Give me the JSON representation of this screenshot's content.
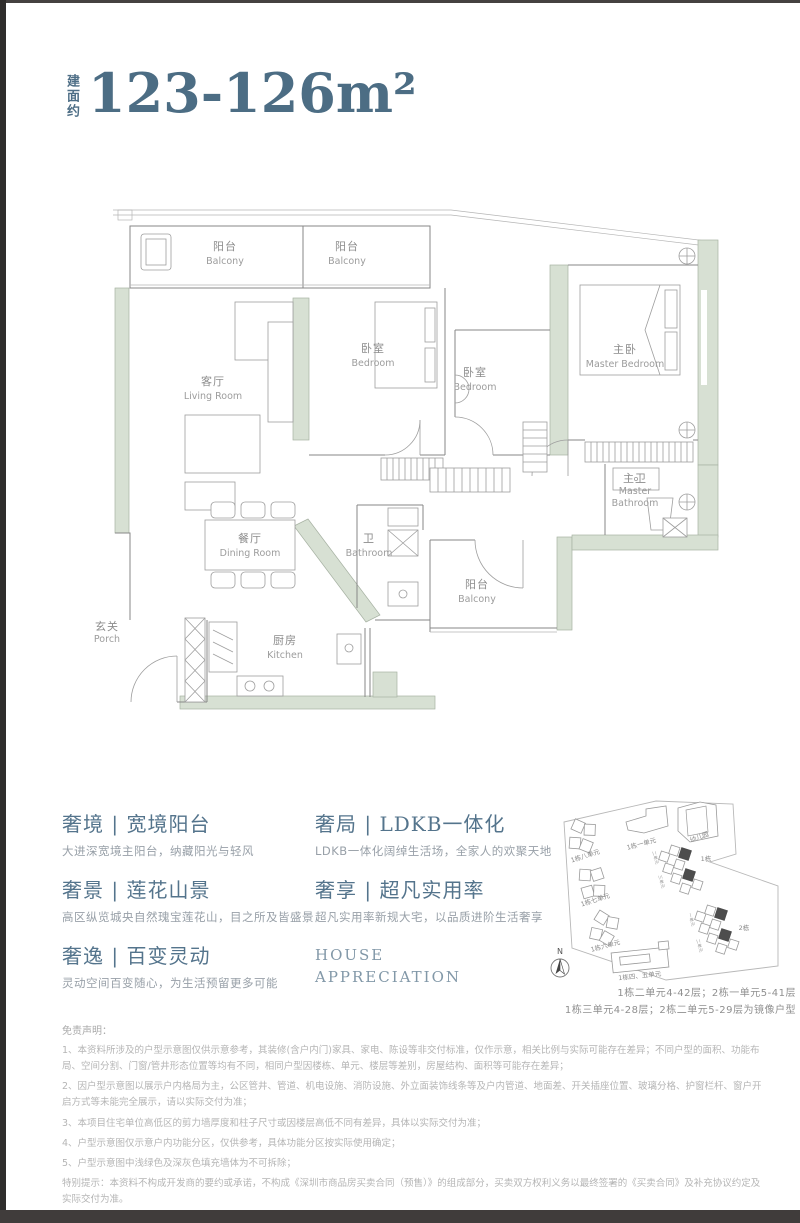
{
  "header": {
    "prefix": "建面约",
    "area": "123-126m²"
  },
  "floorplan": {
    "rooms": [
      {
        "cn": "阳台",
        "en": "Balcony"
      },
      {
        "cn": "阳台",
        "en": "Balcony"
      },
      {
        "cn": "客厅",
        "en": "Living Room"
      },
      {
        "cn": "卧室",
        "en": "Bedroom"
      },
      {
        "cn": "卧室",
        "en": "Bedroom"
      },
      {
        "cn": "主卧",
        "en": "Master Bedroom"
      },
      {
        "cn": "主卫",
        "en1": "Master",
        "en2": "Bathroom"
      },
      {
        "cn": "餐厅",
        "en": "Dining Room"
      },
      {
        "cn": "卫",
        "en": "Bathroom"
      },
      {
        "cn": "阳台",
        "en": "Balcony"
      },
      {
        "cn": "玄关",
        "en": "Porch"
      },
      {
        "cn": "厨房",
        "en": "Kitchen"
      }
    ]
  },
  "features": {
    "left": [
      {
        "title": "奢境 | 宽境阳台",
        "desc": "大进深宽境主阳台，纳藏阳光与轻风"
      },
      {
        "title": "奢景 | 莲花山景",
        "desc": "高区纵览城央自然瑰宝莲花山，目之所及皆盛景"
      },
      {
        "title": "奢逸 | 百变灵动",
        "desc": "灵动空间百变随心，为生活预留更多可能"
      }
    ],
    "right": [
      {
        "title": "奢局 | LDKB一体化",
        "desc": "LDKB一体化阔绰生活场，全家人的欢聚天地"
      },
      {
        "title": "奢享 | 超凡实用率",
        "desc": "超凡实用率新规大宅，以品质进阶生活奢享"
      }
    ],
    "brand_line1": "HOUSE",
    "brand_line2": "APPRECIATION"
  },
  "sitemap": {
    "buildings": {
      "b1u8": "1栋八单元",
      "b1u1": "1栋一单元",
      "kindergarten": "幼儿园",
      "b1": "1栋",
      "b1u7": "1栋七单元",
      "b1u6": "1栋六单元",
      "b2": "2栋",
      "b1u45": "1栋四、五单元",
      "u2": "二单元",
      "u3": "三单元",
      "u1": "一单元",
      "u2b": "二单元"
    },
    "north": "N",
    "caption1": "1栋二单元4-42层；2栋一单元5-41层",
    "caption2": "1栋三单元4-28层；2栋二单元5-29层为镜像户型"
  },
  "disclaimer": {
    "title": "免责声明：",
    "items": [
      "1、本资料所涉及的户型示意图仅供示意参考，其装修(含户内门)家具、家电、陈设等非交付标准，仅作示意，相关比例与实际可能存在差异；不同户型的面积、功能布局、空间分割、门窗/管井形态位置等均有不同，相同户型因楼栋、单元、楼层等差别，房屋结构、面积等可能存在差异；",
      "2、因户型示意图以展示户内格局为主，公区管井、管道、机电设施、消防设施、外立面装饰线条等及户内管道、地面差、开关插座位置、玻璃分格、护窗栏杆、窗户开启方式等未能完全展示，请以实际交付为准；",
      "3、本项目住宅单位高低区的剪力墙厚度和柱子尺寸或因楼层高低不同有差异，具体以实际交付为准；",
      "4、户型示意图仅示意户内功能分区，仅供参考，具体功能分区按实际使用确定；",
      "5、户型示意图中浅绿色及深灰色填充墙体为不可拆除；",
      "特别提示：本资料不构成开发商的要约或承诺，不构成《深圳市商品房买卖合同（预售）》的组成部分，买卖双方权利义务以最终签署的《买卖合同》及补充协议约定及实际交付为准。"
    ]
  },
  "colors": {
    "accent": "#4e6e86",
    "wall_green": "#d7e0d3",
    "text_gray": "#9c9c9c",
    "dark_border": "#3b3837"
  }
}
